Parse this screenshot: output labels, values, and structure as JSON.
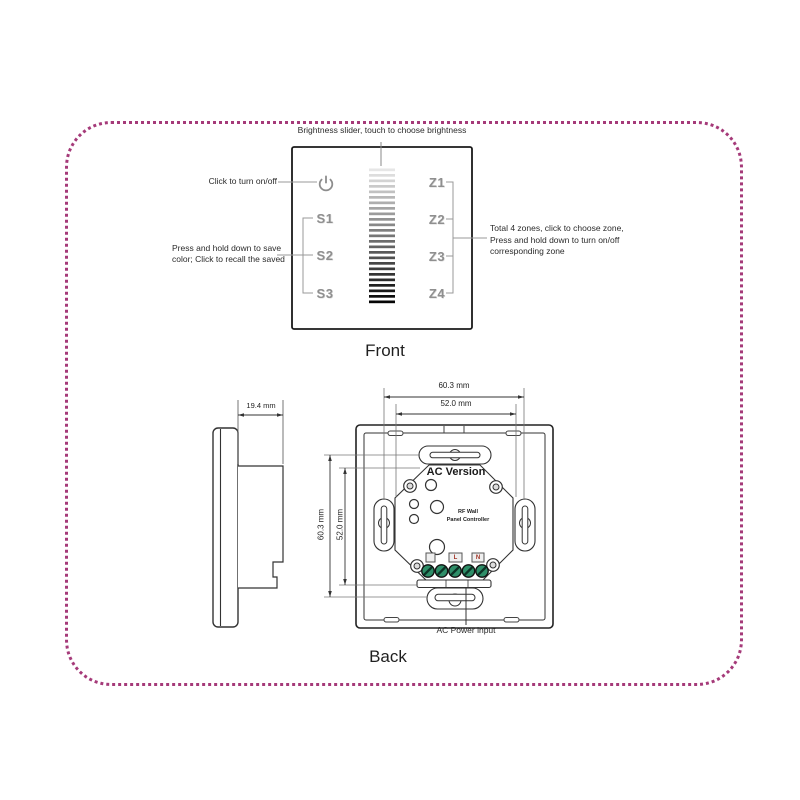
{
  "colors": {
    "page_border": "#a53a79",
    "touch_label_gray": "#8f8f8f",
    "leader_gray": "#999999",
    "terminal_green": "#2e8e68"
  },
  "front": {
    "caption": "Front",
    "annotations": {
      "brightness": "Brightness slider, touch to choose brightness",
      "onoff": "Click to turn on/off",
      "save_line1": "Press and hold down to save",
      "save_line2": "color; Click to recall the saved",
      "zones_line1": "Total 4 zones, click to choose zone,",
      "zones_line2": "Press and hold down to turn on/off",
      "zones_line3": "corresponding zone"
    },
    "scene_labels": [
      "S1",
      "S2",
      "S3"
    ],
    "zone_labels": [
      "Z1",
      "Z2",
      "Z3",
      "Z4"
    ],
    "power_icon": "power-icon",
    "slider": {
      "bars": 25,
      "color_top": "#e6e6e6",
      "color_bottom": "#050505"
    }
  },
  "back": {
    "caption": "Back",
    "module_title": "AC Version",
    "module_line1": "RF Wall",
    "module_line2": "Panel Controller",
    "terminal_labels": {
      "l": "L",
      "n": "N"
    },
    "power_label": "AC Power input",
    "dimensions": {
      "depth": "19.4 mm",
      "width_outer": "60.3 mm",
      "width_inner": "52.0 mm",
      "height_outer": "60.3 mm",
      "height_inner": "52.0 mm"
    }
  }
}
